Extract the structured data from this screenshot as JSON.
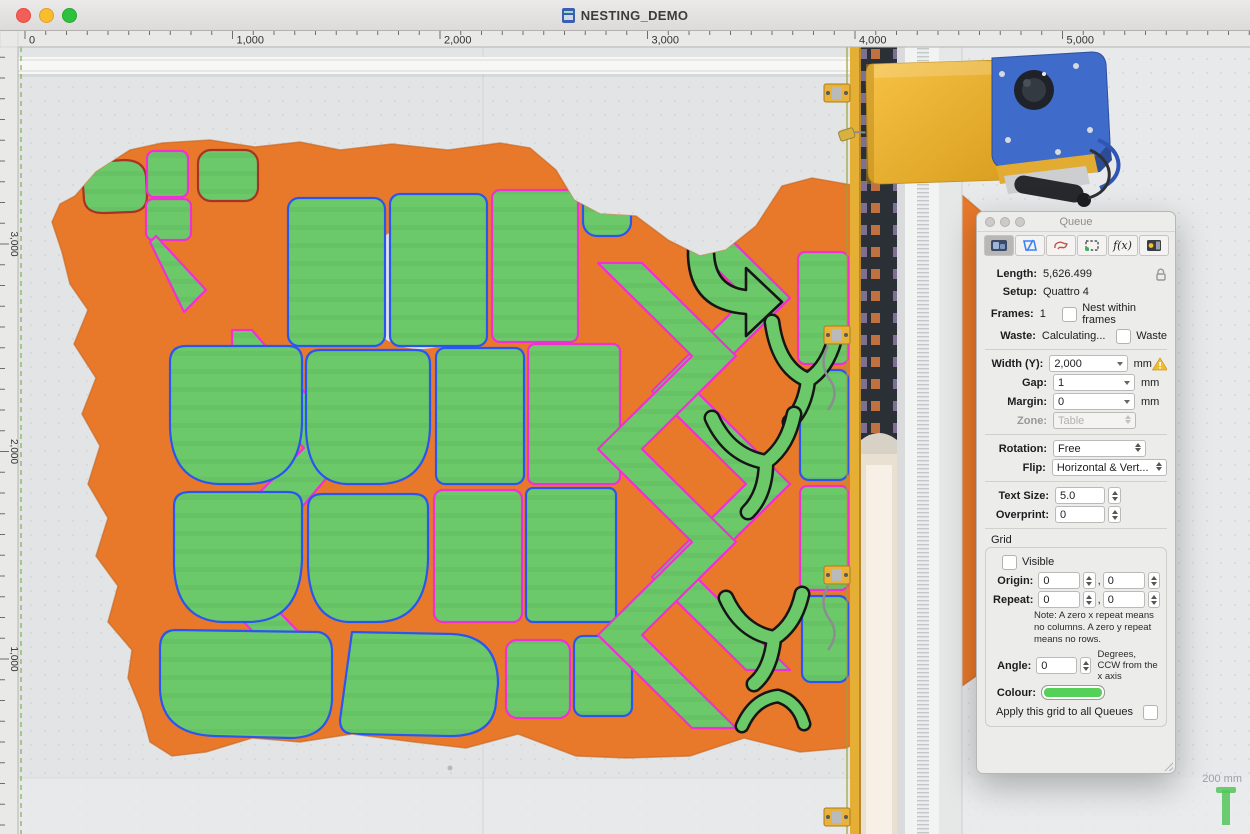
{
  "window": {
    "title": "NESTING_DEMO"
  },
  "rulers": {
    "top_labels": [
      "0",
      "1,000",
      "2,000",
      "3,000",
      "4,000",
      "5,000"
    ],
    "left_labels": [
      "3,000",
      "2,000",
      "1,000"
    ]
  },
  "queue_panel": {
    "title": "Queue",
    "tools": [
      {
        "name": "nest-tool",
        "selected": true
      },
      {
        "name": "queue-pieces-tool",
        "selected": false
      },
      {
        "name": "lasso-tool",
        "selected": false
      },
      {
        "name": "marquee-tool",
        "selected": false
      },
      {
        "name": "function-tool",
        "selected": false,
        "glyph": "f(x)"
      },
      {
        "name": "machine-output-tool",
        "selected": false
      }
    ],
    "fields": {
      "length_label": "Length:",
      "length_value": "5,626.499",
      "setup_label": "Setup:",
      "setup_value": "Quattro 4",
      "frames_label": "Frames:",
      "frames_value": "1",
      "nest_within_frames_label": "Nest within frames",
      "waste_label": "Waste:",
      "waste_value": "Calculating...",
      "waste_checkbox_label": "Waste",
      "width_label": "Width (Y):",
      "width_value": "2,000",
      "width_unit": "mm",
      "gap_label": "Gap:",
      "gap_value": "1",
      "gap_unit": "mm",
      "margin_label": "Margin:",
      "margin_value": "0",
      "margin_unit": "mm",
      "zone_label": "Zone:",
      "zone_value": "Table",
      "rotation_label": "Rotation:",
      "rotation_value": "Free",
      "flip_label": "Flip:",
      "flip_value": "Horizontal & Vert...",
      "text_size_label": "Text Size:",
      "text_size_value": "5.0",
      "overprint_label": "Overprint:",
      "overprint_value": "0"
    },
    "grid": {
      "title": "Grid",
      "visible_label": "Visible",
      "origin_label": "Origin:",
      "origin_x": "0",
      "origin_y": "0",
      "repeat_label": "Repeat:",
      "repeat_x": "0",
      "repeat_y": "0",
      "comma": ",",
      "note": "Note:  A zero x repeat means no columns.  A zero y repeat means no rows.",
      "angle_label": "Angle:",
      "angle_value": "0",
      "angle_hint": "Degrees, CCW from the x axis",
      "colour_label": "Colour:",
      "colour_value": "#55d159",
      "apply_label": "Apply this grid to all Queues"
    }
  },
  "overlay": {
    "scale_text": "200 mm",
    "zoom_text": "1X"
  },
  "colors": {
    "hide": "#e8792a",
    "piece_fill": "#6cc96a",
    "outline_magenta": "#f02fd4",
    "outline_blue": "#2b55f0",
    "outline_dark_red": "#a83324",
    "outline_black": "#161616",
    "machine_yellow": "#eeae2f",
    "machine_blue": "#3f6bca",
    "grid_swatch": "#55d159",
    "warning": "#e8a820"
  }
}
